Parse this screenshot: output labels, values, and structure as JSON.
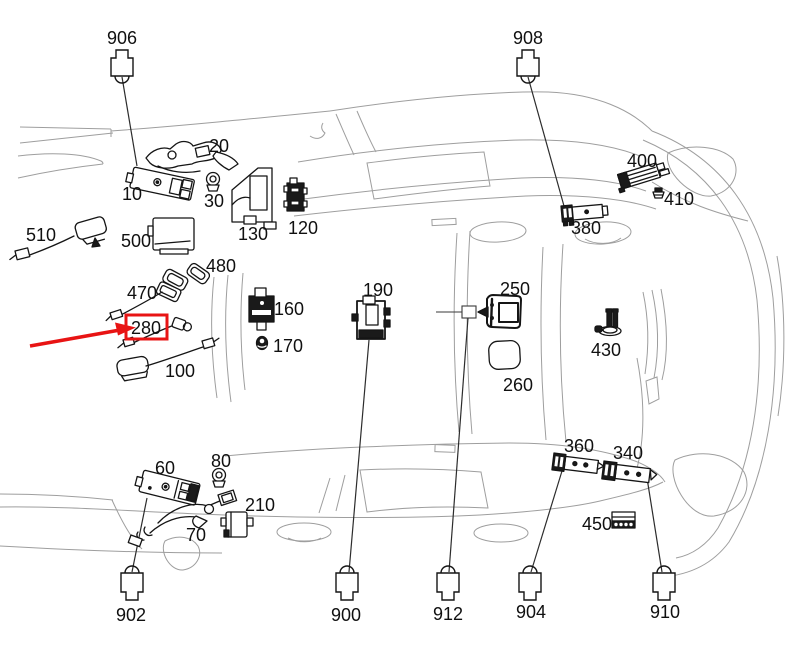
{
  "diagram": {
    "type": "vehicle-component-location-diagram",
    "vehicle_view": "top-plan-outline",
    "part_labels": [
      "10",
      "20",
      "30",
      "60",
      "70",
      "80",
      "100",
      "120",
      "130",
      "160",
      "170",
      "190",
      "210",
      "250",
      "260",
      "280",
      "340",
      "360",
      "380",
      "400",
      "410",
      "430",
      "450",
      "470",
      "480",
      "500",
      "510"
    ],
    "top_connector_labels": [
      "906",
      "908"
    ],
    "bottom_connector_labels": [
      "902",
      "900",
      "912",
      "904",
      "910"
    ],
    "highlight": {
      "part": "280",
      "shape": "box-and-arrow",
      "color": "#e81414"
    },
    "colors": {
      "background": "#ffffff",
      "car_outline": "#9e9e9e",
      "parts": "#151515",
      "labels": "#101010"
    }
  }
}
